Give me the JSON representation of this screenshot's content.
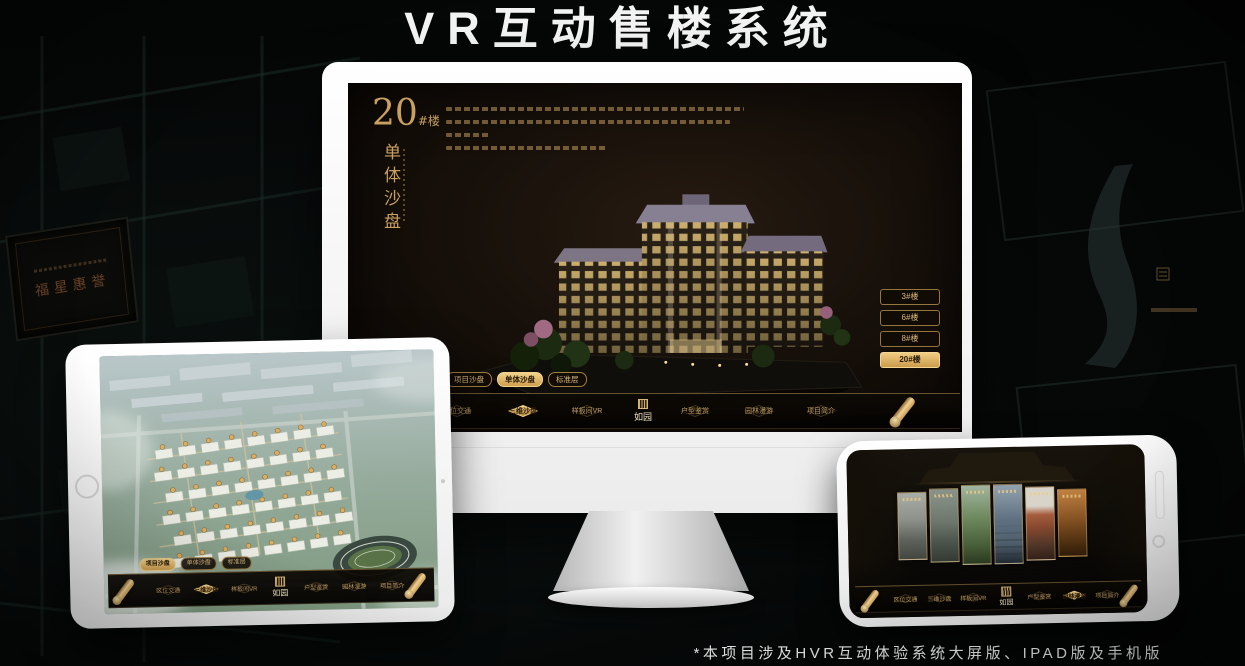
{
  "poster": {
    "title": "VR互动售楼系统",
    "footnote": "*本项目涉及HVR互动体验系统大屏版、IPAD版及手机版"
  },
  "brand": {
    "logo_text": "如园",
    "background_plaque_text": "福星惠誉"
  },
  "colors": {
    "gold": "#c9a05f",
    "gold_bright": "#f0cd84",
    "screen_background": "#17100a",
    "monitor_body": "#f4f4f4"
  },
  "desktop_screen": {
    "unit_number": "20",
    "unit_number_suffix": "#楼",
    "unit_subtitle": "单体沙盘",
    "floor_buttons": [
      {
        "label": "3#楼",
        "active": false
      },
      {
        "label": "6#楼",
        "active": false
      },
      {
        "label": "8#楼",
        "active": false
      },
      {
        "label": "20#楼",
        "active": true
      }
    ],
    "sub_tabs": [
      {
        "label": "项目沙盘",
        "active": false
      },
      {
        "label": "单体沙盘",
        "active": true
      },
      {
        "label": "标准层",
        "active": false
      }
    ],
    "nav_items": [
      {
        "label": "区位交通",
        "active": false
      },
      {
        "label": "三维沙盘",
        "active": true
      },
      {
        "label": "样板间VR",
        "active": false
      },
      {
        "label": "户型鉴赏",
        "active": false
      },
      {
        "label": "园林漫游",
        "active": false
      },
      {
        "label": "项目简介",
        "active": false
      }
    ]
  },
  "tablet_screen": {
    "sub_tabs": [
      {
        "label": "项目沙盘",
        "active": true
      },
      {
        "label": "单体沙盘",
        "active": false
      },
      {
        "label": "标准层",
        "active": false
      }
    ],
    "nav_items": [
      {
        "label": "区位交通",
        "active": false
      },
      {
        "label": "三维沙盘",
        "active": true
      },
      {
        "label": "样板间VR",
        "active": false
      },
      {
        "label": "户型鉴赏",
        "active": false
      },
      {
        "label": "园林漫游",
        "active": false
      },
      {
        "label": "项目简介",
        "active": false
      }
    ]
  },
  "phone_screen": {
    "nav_items": [
      {
        "label": "区位交通",
        "active": false
      },
      {
        "label": "三维沙盘",
        "active": false
      },
      {
        "label": "样板间VR",
        "active": false
      },
      {
        "label": "户型鉴赏",
        "active": false
      },
      {
        "label": "园林漫游",
        "active": true
      },
      {
        "label": "项目简介",
        "active": false
      }
    ]
  }
}
